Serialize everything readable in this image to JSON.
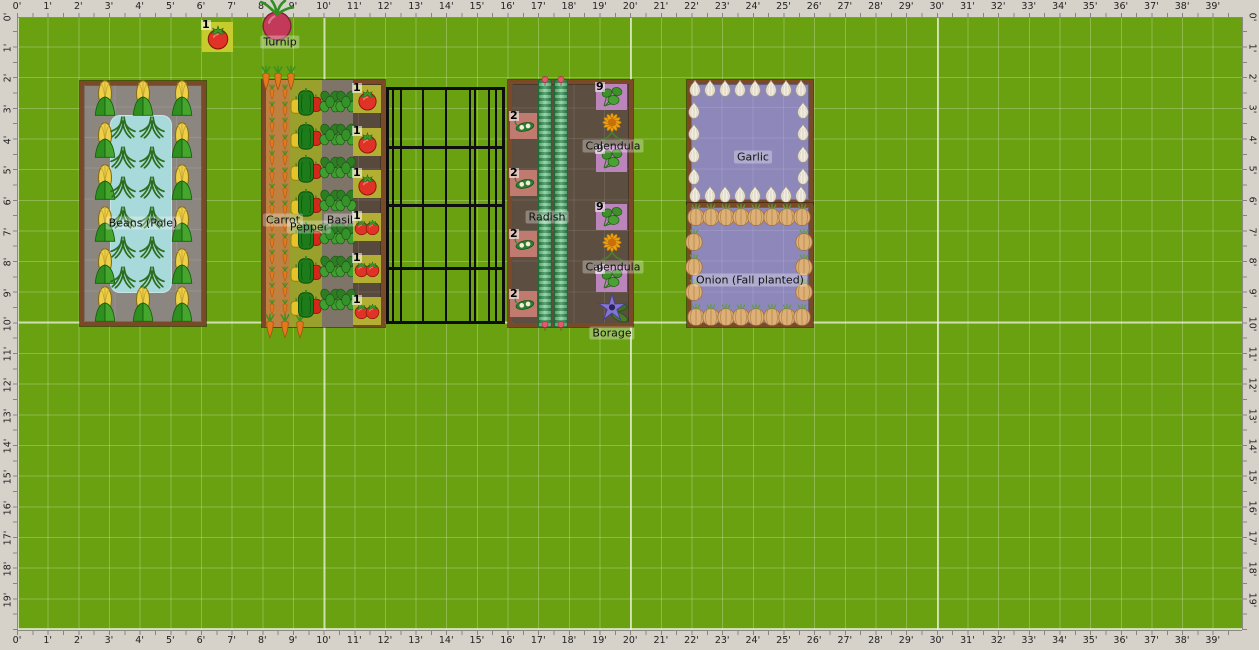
{
  "colors": {
    "field_green": "#69a111",
    "grid_minor": "rgba(220,232,190,0.33)",
    "grid_major": "rgba(235,240,220,0.75)",
    "ruler_bg": "#d6d2ca",
    "bed_border": "#7a4a26",
    "beans_bed_soil": "#8c8680",
    "water_zone": "#a9dadb",
    "mixed_bed_soil": "#57493c",
    "carrot_zone": "#bf8142",
    "pepper_zone": "#9aa02c",
    "basil_zone": "#7e7568",
    "tomato_cell": "#b2af33",
    "radish_bed_soil": "#5c4e40",
    "pod_cell": "#c17a70",
    "leafy_cell": "#bb84bb",
    "allium_bed_soil": "#8e88ba",
    "highlight_cell": "#c6cc2e",
    "fence_black": "#0e0e0e"
  },
  "rulers": {
    "horizontal": [
      "0'",
      "1'",
      "2'",
      "3'",
      "4'",
      "5'",
      "6'",
      "7'",
      "8'",
      "9'",
      "10'",
      "11'",
      "12'",
      "13'",
      "14'",
      "15'",
      "16'",
      "17'",
      "18'",
      "19'",
      "20'",
      "21'",
      "22'",
      "23'",
      "24'",
      "25'",
      "26'",
      "27'",
      "28'",
      "29'",
      "30'",
      "31'",
      "32'",
      "33'",
      "34'",
      "35'",
      "36'",
      "37'",
      "38'",
      "39'"
    ],
    "vertical": [
      "0'",
      "1'",
      "2'",
      "3'",
      "4'",
      "5'",
      "6'",
      "7'",
      "8'",
      "9'",
      "10'",
      "11'",
      "12'",
      "13'",
      "14'",
      "15'",
      "16'",
      "17'",
      "18'",
      "19'"
    ]
  },
  "beds": [
    {
      "name": "beans-pole-bed",
      "rect": [
        80,
        81,
        126,
        245
      ],
      "fill": "#8c8680",
      "zones": [
        {
          "name": "water-zone",
          "cls": "pool",
          "rect": [
            30,
            34,
            62,
            178
          ],
          "fill": "#a9dadb"
        }
      ],
      "plants": [
        {
          "type": "centers",
          "icon": "corn",
          "size": 26,
          "points": [
            [
              25,
              17
            ],
            [
              25,
              59
            ],
            [
              25,
              101
            ],
            [
              25,
              143
            ],
            [
              25,
              185
            ],
            [
              25,
              223
            ],
            [
              102,
              17
            ],
            [
              102,
              59
            ],
            [
              102,
              101
            ],
            [
              102,
              143
            ],
            [
              102,
              185
            ],
            [
              102,
              223
            ],
            [
              63,
              17
            ],
            [
              63,
              223
            ]
          ]
        },
        {
          "type": "centers",
          "icon": "beans",
          "size": 26,
          "points": [
            [
              43,
              46
            ],
            [
              72,
              46
            ],
            [
              43,
              76
            ],
            [
              72,
              76
            ],
            [
              43,
              106
            ],
            [
              72,
              106
            ],
            [
              43,
              136
            ],
            [
              72,
              136
            ],
            [
              43,
              166
            ],
            [
              72,
              166
            ],
            [
              43,
              196
            ],
            [
              72,
              196
            ]
          ]
        }
      ]
    },
    {
      "name": "carrot-pepper-basil-tomato-bed",
      "rect": [
        262,
        80,
        123,
        247
      ],
      "fill": "#57493c",
      "zones": [
        {
          "name": "carrot-zone",
          "rect": [
            4,
            0,
            24,
            247
          ],
          "fill": "#bf8142"
        },
        {
          "name": "pepper-zone",
          "cls": "alt-rows",
          "rect": [
            28,
            0,
            32,
            247
          ],
          "fill": "#9aa02c"
        },
        {
          "name": "basil-zone",
          "rect": [
            60,
            0,
            31,
            247
          ],
          "fill": "#7e7568"
        }
      ],
      "plants": [
        {
          "type": "grid",
          "icon": "carrot",
          "size": 9,
          "x0": 10,
          "y0": 12,
          "dx": 13,
          "dy": 16.5,
          "cols": 2,
          "rows": 14
        },
        {
          "type": "centers",
          "icon": "carrot",
          "size": 14,
          "points": [
            [
              4,
              -2
            ],
            [
              16,
              -2
            ],
            [
              29,
              -2
            ],
            [
              8,
              246
            ],
            [
              23,
              246
            ],
            [
              38,
              246
            ]
          ]
        },
        {
          "type": "grid",
          "icon": "pepper",
          "size": 34,
          "x0": 44,
          "y0": 22,
          "dx": 0,
          "dy": 33.6,
          "cols": 1,
          "rows": 7
        },
        {
          "type": "grid",
          "icon": "basil",
          "size": 23,
          "x0": 68,
          "y0": 22,
          "dx": 16,
          "dy": 33,
          "cols": 2,
          "rows": 7
        },
        {
          "type": "cells",
          "icon": "tomato",
          "badge": "1",
          "fill": "#b2af33",
          "x": 91,
          "w": 28,
          "h": 28,
          "tops": [
            5,
            48,
            90,
            133,
            175,
            217
          ],
          "counts": [
            1,
            1,
            1,
            2,
            2,
            2
          ],
          "size": 23
        }
      ]
    },
    {
      "name": "radish-companion-bed",
      "rect": [
        508,
        80,
        125,
        247
      ],
      "fill": "#5c4e40",
      "zones": [
        {
          "name": "radish-row",
          "cls": "radish",
          "rect": [
            30,
            0,
            14,
            247
          ]
        },
        {
          "name": "radish-row",
          "cls": "radish",
          "rect": [
            46,
            0,
            14,
            247
          ]
        }
      ],
      "plants": [
        {
          "type": "centers",
          "icon": "radishtip",
          "size": 8,
          "points": [
            [
              37,
              1
            ],
            [
              53,
              1
            ],
            [
              37,
              246
            ],
            [
              53,
              246
            ]
          ]
        },
        {
          "type": "cells",
          "icon": "pod",
          "badge": "2",
          "fill": "#c17a70",
          "x": 2,
          "w": 27,
          "h": 26,
          "tops": [
            33,
            90,
            151,
            211
          ],
          "counts": [
            1,
            1,
            1,
            1
          ],
          "size": 24
        },
        {
          "type": "cells",
          "icon": "leafy",
          "badge": "9",
          "fill": "#bb84bb",
          "x": 88,
          "w": 31,
          "h": 26,
          "tops": [
            4,
            66,
            124,
            186
          ],
          "counts": [
            1,
            1,
            1,
            1
          ],
          "size": 24
        },
        {
          "type": "centers",
          "icon": "calendula",
          "size": 33,
          "points": [
            [
              104,
              46
            ],
            [
              104,
              166
            ]
          ]
        },
        {
          "type": "centers",
          "icon": "borage",
          "size": 36,
          "points": [
            [
              104,
              228
            ]
          ]
        }
      ]
    },
    {
      "name": "garlic-bed",
      "rect": [
        687,
        80,
        126,
        124
      ],
      "fill": "#8e88ba",
      "zones": [],
      "plants": [
        {
          "type": "grid",
          "icon": "garlic",
          "size": 16,
          "x0": 8,
          "y0": 8,
          "dx": 15.1,
          "dy": 0,
          "cols": 8,
          "rows": 1
        },
        {
          "type": "grid",
          "icon": "garlic",
          "size": 16,
          "x0": 8,
          "y0": 114,
          "dx": 15.1,
          "dy": 0,
          "cols": 8,
          "rows": 1
        },
        {
          "type": "grid",
          "icon": "garlic",
          "size": 16,
          "x0": 7,
          "y0": 30,
          "dx": 0,
          "dy": 22,
          "cols": 1,
          "rows": 4
        },
        {
          "type": "grid",
          "icon": "garlic",
          "size": 16,
          "x0": 116,
          "y0": 30,
          "dx": 0,
          "dy": 22,
          "cols": 1,
          "rows": 4
        }
      ]
    },
    {
      "name": "onion-bed",
      "rect": [
        687,
        203,
        126,
        124
      ],
      "fill": "#8e88ba",
      "zones": [],
      "plants": [
        {
          "type": "grid",
          "icon": "onion",
          "size": 20,
          "x0": 9,
          "y0": 12,
          "dx": 15.1,
          "dy": 0,
          "cols": 8,
          "rows": 1
        },
        {
          "type": "grid",
          "icon": "onion",
          "size": 20,
          "x0": 9,
          "y0": 112,
          "dx": 15.1,
          "dy": 0,
          "cols": 8,
          "rows": 1
        },
        {
          "type": "grid",
          "icon": "onion",
          "size": 20,
          "x0": 7,
          "y0": 37,
          "dx": 0,
          "dy": 25,
          "cols": 1,
          "rows": 3
        },
        {
          "type": "grid",
          "icon": "onion",
          "size": 20,
          "x0": 117,
          "y0": 37,
          "dx": 0,
          "dy": 25,
          "cols": 1,
          "rows": 3
        }
      ]
    }
  ],
  "fence": {
    "name": "trellis-fence",
    "rect": [
      386,
      87,
      119,
      237
    ],
    "rails": [
      59,
      117,
      180
    ],
    "bars": [
      6,
      14,
      36,
      59,
      83,
      88,
      102,
      109
    ]
  },
  "loose_plants": [
    {
      "type": "cells",
      "icon": "tomato",
      "badge": "1",
      "fill": "#c6cc2e",
      "x": 202,
      "w": 31,
      "h": 30,
      "tops": [
        22
      ],
      "counts": [
        1
      ],
      "size": 26
    },
    {
      "type": "centers",
      "icon": "turnip",
      "size": 40,
      "points": [
        [
          277,
          22
        ]
      ]
    }
  ],
  "labels": [
    {
      "text": "Turnip",
      "x": 280,
      "y": 42
    },
    {
      "text": "Beans (Pole)",
      "x": 143,
      "y": 223
    },
    {
      "text": "Carrot",
      "x": 283,
      "y": 220
    },
    {
      "text": "Pepper",
      "x": 309,
      "y": 227
    },
    {
      "text": "Basil",
      "x": 340,
      "y": 220
    },
    {
      "text": "Radish",
      "x": 547,
      "y": 217
    },
    {
      "text": "Calendula",
      "x": 613,
      "y": 146
    },
    {
      "text": "Calendula",
      "x": 613,
      "y": 267
    },
    {
      "text": "Borage",
      "x": 612,
      "y": 333
    },
    {
      "text": "Garlic",
      "x": 753,
      "y": 157
    },
    {
      "text": "Onion (Fall planted)",
      "x": 750,
      "y": 280
    }
  ]
}
